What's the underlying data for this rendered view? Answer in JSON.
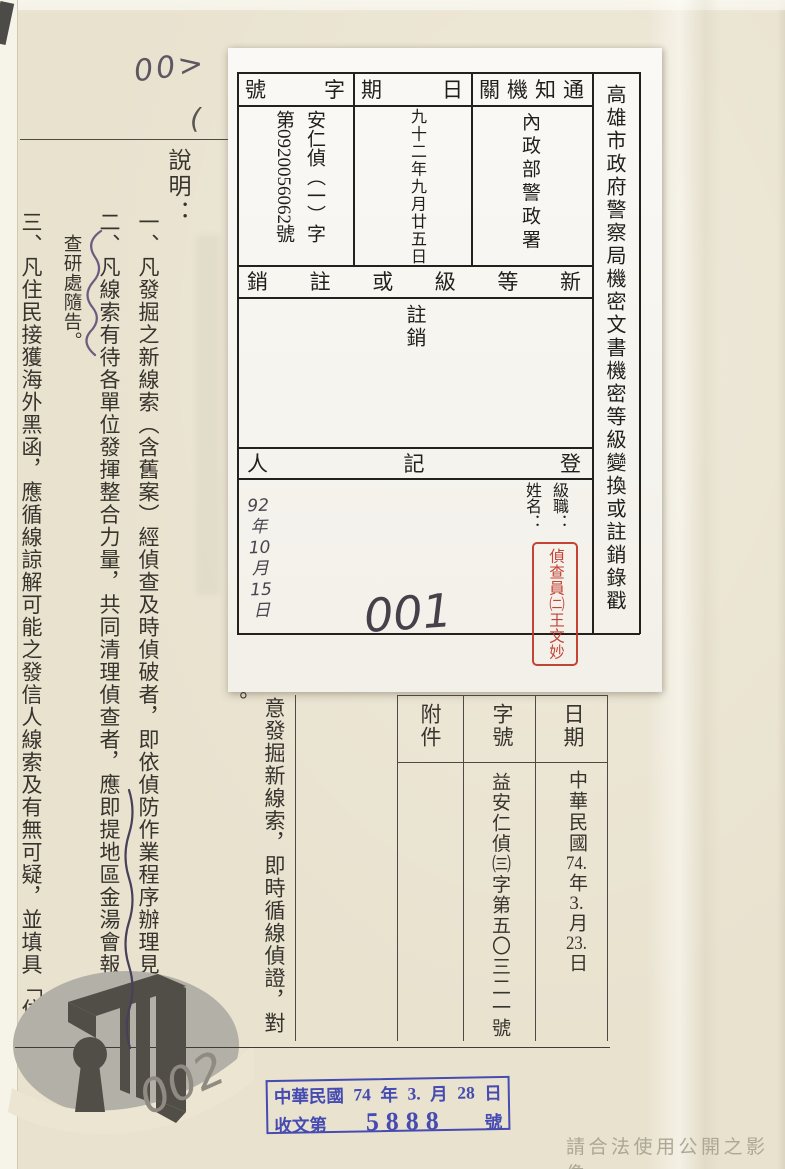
{
  "page": {
    "footer_note": "請合法使用公開之影像",
    "colors": {
      "paper": "#e9e2cf",
      "card_paper": "#f5f3ed",
      "red_stamp": "#c03527",
      "blue_stamp": "#3d43b0",
      "pencil": "#4a4550"
    }
  },
  "handwriting": {
    "top_left_mark": "00>",
    "paren_mark": "(",
    "card_number": "001",
    "page_number": "002",
    "card_date_lines": [
      "92",
      "年",
      "10",
      "月",
      "15",
      "日"
    ]
  },
  "card": {
    "title": "高雄市政府警察局機密文書機密等級變換或註銷錄戳",
    "headers": {
      "notify_org": "通知機關",
      "date": "日期",
      "doc_no": "字號",
      "new_level": "新等級或註銷",
      "registrar": "登記人"
    },
    "values": {
      "notify_org": "內政部警政署",
      "date": "九十二年九月廿五日",
      "doc_no_line1": "安仁偵（一）字",
      "doc_no_line2": "第0920056062號",
      "new_level": "註銷",
      "rank_label": "級職：",
      "name_label": "姓名：",
      "registrar_stamp": "偵查員㈡王文妙"
    }
  },
  "doc": {
    "heading": "說明：",
    "items": [
      "一、凡發掘之新線索（含舊案）經偵查及時偵破者，即依偵防作業程序辦理見告。",
      "二、凡線索有待各單位發揮整合力量，共同清理偵查者，應即提地區金湯會報會同偵",
      "三、凡住民接獲海外黑函，應循線諒解可能之發信人線索及有無可疑，並填具「住"
    ],
    "margin_note": "查研處隨告。",
    "fragment_period": "。",
    "fragment_column": "意發掘新線索，即時循線偵證，對",
    "bottom_table": {
      "headers": {
        "date": "日期",
        "doc_no": "字號",
        "attachment": "附件"
      },
      "date_parts": [
        "中華民國",
        "74.",
        "年",
        "3.",
        "月",
        "23.",
        "日"
      ],
      "doc_no": "益安仁偵㈢字第五〇三二一號",
      "attachment": ""
    }
  },
  "received_stamp": {
    "line1_parts": [
      "中華民國",
      "74",
      "年",
      "3.",
      "月",
      "28",
      "日"
    ],
    "line2_prefix": "收文第",
    "line2_number": "5888",
    "line2_suffix": "號"
  }
}
